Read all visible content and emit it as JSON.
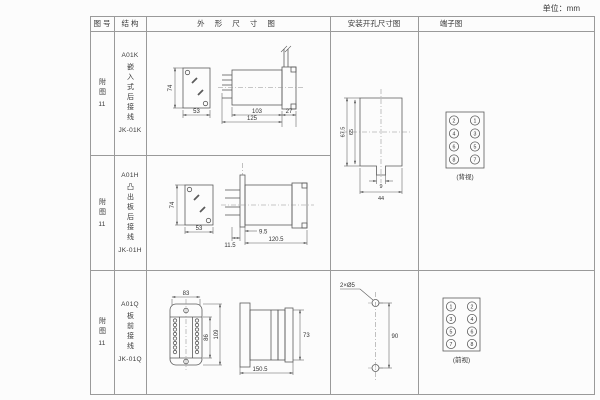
{
  "unit_label": "单位：mm",
  "header": {
    "fig_no": "图 号",
    "structure": "结 构",
    "outline": "外 形 尺 寸 图",
    "mounting": "安装开孔尺寸图",
    "terminal": "端子图"
  },
  "rows": [
    {
      "fig_prefix": "附图",
      "fig_num": "11",
      "model": "A01K",
      "structure_text": "嵌入式后接线",
      "code": "JK-01K"
    },
    {
      "fig_prefix": "附图",
      "fig_num": "11",
      "model": "A01H",
      "structure_text": "凸出板后接线",
      "code": "JK-01H"
    },
    {
      "fig_prefix": "附图",
      "fig_num": "11",
      "model": "A01Q",
      "structure_text": "板前接线",
      "code": "JK-01Q"
    }
  ],
  "outline_k": {
    "front_h": "74",
    "front_w": "53",
    "body_len": "103",
    "total_len": "125",
    "rear_len": "27"
  },
  "outline_h": {
    "front_h": "74",
    "front_w": "53",
    "flange_off": "9.5",
    "rear_len": "11.5",
    "total_len": "120.5"
  },
  "outline_q": {
    "front_w": "83",
    "inner_h": "86",
    "front_h": "109",
    "side_h": "73",
    "total_len": "150.5"
  },
  "mounting_kh": {
    "height": "67.5",
    "inner_height": "65",
    "notch_w": "9",
    "width": "44"
  },
  "mounting_q": {
    "hole_label": "2×Ø5",
    "spacing": "90"
  },
  "terminal_kh": {
    "cells": [
      "2",
      "1",
      "4",
      "3",
      "6",
      "5",
      "8",
      "7"
    ],
    "view_label": "(背视)"
  },
  "terminal_q": {
    "cells": [
      "1",
      "2",
      "3",
      "4",
      "5",
      "6",
      "7",
      "8"
    ],
    "view_label": "(前视)"
  }
}
